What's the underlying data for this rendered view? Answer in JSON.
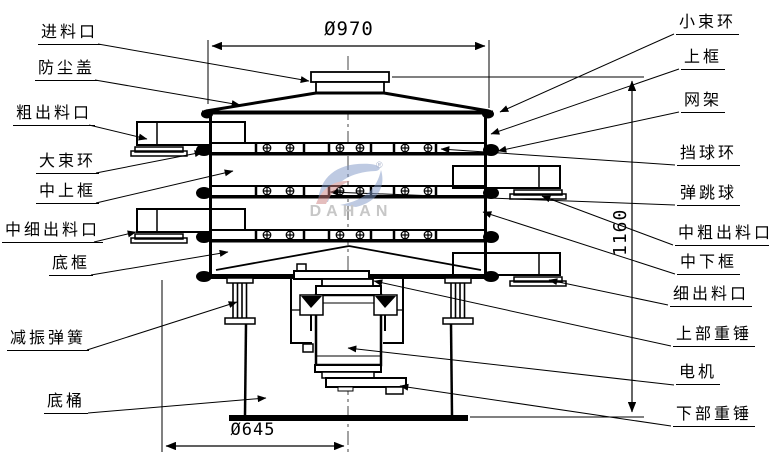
{
  "diagram": {
    "type": "vibrating-sieve-technical-drawing",
    "watermark": {
      "brand": "DAHAN",
      "registered": "®"
    },
    "dimensions": {
      "top_diameter": "Ø970",
      "total_height": "1160",
      "base_diameter": "Ø645"
    },
    "labels_left": [
      {
        "part": "feed-inlet",
        "text": "进料口"
      },
      {
        "part": "dust-cover",
        "text": "防尘盖"
      },
      {
        "part": "coarse-outlet",
        "text": "粗出料口"
      },
      {
        "part": "large-clamp-ring",
        "text": "大束环"
      },
      {
        "part": "middle-upper-frame",
        "text": "中上框"
      },
      {
        "part": "medium-fine-outlet",
        "text": "中细出料口"
      },
      {
        "part": "bottom-frame",
        "text": "底框"
      },
      {
        "part": "damping-spring",
        "text": "减振弹簧"
      },
      {
        "part": "bottom-barrel",
        "text": "底桶"
      }
    ],
    "labels_right": [
      {
        "part": "small-clamp-ring",
        "text": "小束环"
      },
      {
        "part": "upper-frame",
        "text": "上框"
      },
      {
        "part": "mesh-frame",
        "text": "网架"
      },
      {
        "part": "ball-stop-ring",
        "text": "挡球环"
      },
      {
        "part": "bouncing-ball",
        "text": "弹跳球"
      },
      {
        "part": "medium-coarse-outlet",
        "text": "中粗出料口"
      },
      {
        "part": "middle-lower-frame",
        "text": "中下框"
      },
      {
        "part": "fine-outlet",
        "text": "细出料口"
      },
      {
        "part": "upper-weight",
        "text": "上部重锤"
      },
      {
        "part": "motor",
        "text": "电机"
      },
      {
        "part": "lower-weight",
        "text": "下部重锤"
      }
    ]
  }
}
